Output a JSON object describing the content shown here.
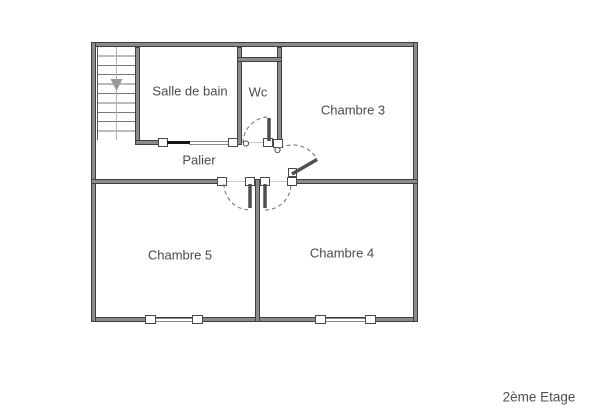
{
  "floor_plan": {
    "floor_label": "2ème Etage",
    "rooms": [
      {
        "id": "salle-de-bain",
        "label": "Salle de bain"
      },
      {
        "id": "wc",
        "label": "Wc"
      },
      {
        "id": "chambre-3",
        "label": "Chambre 3"
      },
      {
        "id": "palier",
        "label": "Palier"
      },
      {
        "id": "chambre-5",
        "label": "Chambre 5"
      },
      {
        "id": "chambre-4",
        "label": "Chambre 4"
      }
    ],
    "icons": {
      "stairs_direction_icon": "arrow-down"
    },
    "colors": {
      "wall": "#4f4f4f",
      "label_text": "#4a4a4a",
      "sliding_door_leaf": "#151515",
      "door_swing_arc": "#787878",
      "stair_arrow": "#999999",
      "background": "#ffffff"
    }
  }
}
